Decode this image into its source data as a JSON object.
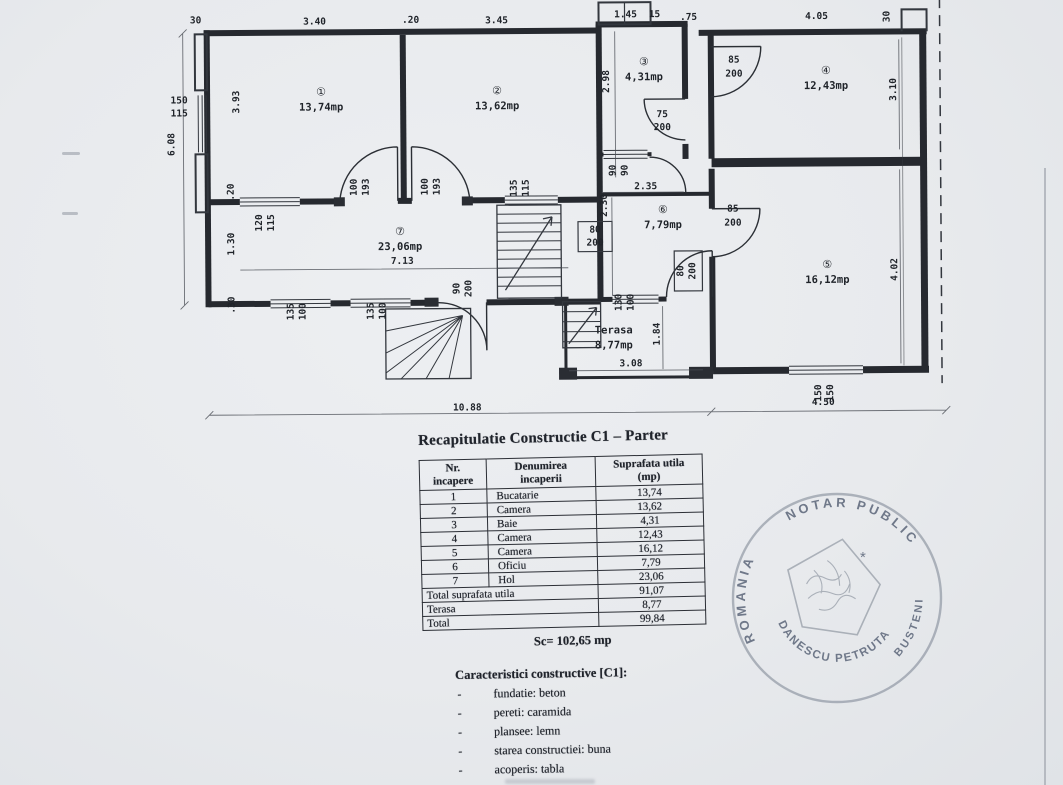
{
  "plan": {
    "terasa": {
      "line1": "Terasa",
      "line2": "8,77mp"
    },
    "rooms": [
      {
        "num": "①",
        "area": "13,74mp",
        "x": 322,
        "y": 94
      },
      {
        "num": "②",
        "area": "13,62mp",
        "x": 498,
        "y": 94
      },
      {
        "num": "③",
        "area": "4,31mp",
        "x": 645,
        "y": 66
      },
      {
        "num": "④",
        "area": "12,43mp",
        "x": 827,
        "y": 76
      },
      {
        "num": "⑤",
        "area": "16,12mp",
        "x": 827,
        "y": 270
      },
      {
        "num": "⑥",
        "area": "7,79mp",
        "x": 663,
        "y": 214
      },
      {
        "num": "⑦",
        "area": "23,06mp",
        "x": 400,
        "y": 234
      }
    ],
    "labels": [
      [
        "30",
        197,
        21,
        0
      ],
      [
        "3.40",
        316,
        23,
        0
      ],
      [
        ".20",
        412,
        22,
        0
      ],
      [
        "3.45",
        498,
        23,
        0
      ],
      [
        "1.45",
        627,
        18,
        0
      ],
      [
        "15",
        656,
        18,
        0
      ],
      [
        ".75",
        690,
        21,
        0
      ],
      [
        "4.05",
        818,
        21,
        0
      ],
      [
        "30",
        891,
        19,
        1
      ],
      [
        "150",
        180,
        101,
        0
      ],
      [
        "115",
        180,
        114,
        0
      ],
      [
        "6.08",
        175,
        142,
        1
      ],
      [
        "3.93",
        240,
        100,
        1
      ],
      [
        "2.98",
        610,
        82,
        1
      ],
      [
        "75",
        663,
        118,
        0
      ],
      [
        "200",
        663,
        131,
        0
      ],
      [
        "90",
        616,
        171,
        1
      ],
      [
        "90",
        628,
        171,
        1
      ],
      [
        "2.35",
        646,
        190,
        0
      ],
      [
        "85",
        735,
        64,
        0
      ],
      [
        "200",
        735,
        78,
        0
      ],
      [
        "3.10",
        897,
        92,
        1
      ],
      [
        "120",
        262,
        221,
        1
      ],
      [
        "115",
        274,
        221,
        1
      ],
      [
        "100",
        357,
        186,
        1
      ],
      [
        "193",
        369,
        186,
        1
      ],
      [
        "100",
        428,
        186,
        1
      ],
      [
        "193",
        440,
        186,
        1
      ],
      [
        "135",
        517,
        188,
        1
      ],
      [
        "115",
        529,
        188,
        1
      ],
      [
        ".20",
        234,
        190,
        1
      ],
      [
        "1.30",
        234,
        242,
        1
      ],
      [
        ".30",
        234,
        303,
        1
      ],
      [
        "7.13",
        402,
        263,
        0
      ],
      [
        "80",
        595,
        233,
        0
      ],
      [
        "200",
        595,
        246,
        0
      ],
      [
        "135",
        293,
        310,
        1
      ],
      [
        "100",
        305,
        310,
        1
      ],
      [
        "135",
        373,
        310,
        1
      ],
      [
        "100",
        385,
        310,
        1
      ],
      [
        "90",
        459,
        288,
        1
      ],
      [
        "200",
        471,
        288,
        1
      ],
      [
        "2.30",
        607,
        206,
        1
      ],
      [
        "85",
        733,
        213,
        0
      ],
      [
        "200",
        733,
        227,
        0
      ],
      [
        "80",
        683,
        272,
        1
      ],
      [
        "200",
        695,
        272,
        1
      ],
      [
        "130",
        621,
        303,
        1
      ],
      [
        "100",
        633,
        303,
        1
      ],
      [
        "1.84",
        659,
        335,
        1
      ],
      [
        "3.08",
        630,
        367,
        0
      ],
      [
        "4.02",
        897,
        272,
        1
      ],
      [
        "150",
        820,
        395,
        1
      ],
      [
        "150",
        832,
        395,
        1
      ],
      [
        "10.88",
        466,
        410,
        0
      ],
      [
        "4.50",
        822,
        407,
        0
      ]
    ]
  },
  "recap": {
    "title": "Recapitulatie Constructie C1 – Parter",
    "table": {
      "headers": [
        [
          "Nr.",
          "incapere"
        ],
        [
          "Denumirea",
          "incaperii"
        ],
        [
          "Suprafata utila",
          "(mp)"
        ]
      ],
      "rows": [
        [
          "1",
          "Bucatarie",
          "13,74"
        ],
        [
          "2",
          "Camera",
          "13,62"
        ],
        [
          "3",
          "Baie",
          "4,31"
        ],
        [
          "4",
          "Camera",
          "12,43"
        ],
        [
          "5",
          "Camera",
          "16,12"
        ],
        [
          "6",
          "Oficiu",
          "7,79"
        ],
        [
          "7",
          "Hol",
          "23,06"
        ]
      ],
      "summary": [
        [
          "Total suprafata utila",
          "91,07"
        ],
        [
          "Terasa",
          "8,77"
        ],
        [
          "Total",
          "99,84"
        ]
      ]
    },
    "sc_line": "Sc= 102,65 mp"
  },
  "characteristics": {
    "title": "Caracteristici constructive [C1]:",
    "bullet": "-",
    "items": [
      "fundatie: beton",
      "pereti: caramida",
      "plansee: lemn",
      "starea constructiei: buna",
      "acoperis: tabla"
    ]
  },
  "stamp": {
    "country": "ROMANIA",
    "title": "NOTAR PUBLIC",
    "name": "DANESCU PETRUTA",
    "city": "BUSTENI",
    "star": "*",
    "ink": "#78818f"
  }
}
